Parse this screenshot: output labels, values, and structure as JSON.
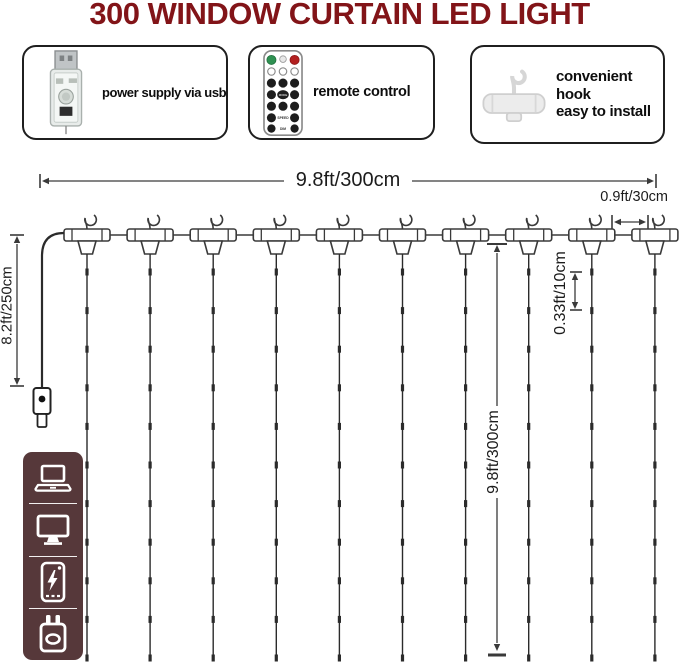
{
  "title": "300 WINDOW CURTAIN LED LIGHT",
  "features": {
    "power": {
      "label": "power supply via usb",
      "icon": "usb-plug-icon"
    },
    "remote": {
      "label": "remote control",
      "icon": "remote-control-icon"
    },
    "hook": {
      "label_line1": "convenient hook",
      "label_line2": "easy to install",
      "icon": "hanger-hook-icon"
    }
  },
  "remote_buttons": {
    "mode": "MODE",
    "speed": "SPEED",
    "dim": "DIM"
  },
  "dimensions": {
    "curtain_width": "9.8ft/300cm",
    "hook_spacing": "0.9ft/30cm",
    "lead_cable": "8.2ft/250cm",
    "curtain_drop": "9.8ft/300cm",
    "led_spacing": "0.33ft/10cm"
  },
  "diagram": {
    "hook_count": 10,
    "led_marks_per_string": 11
  },
  "sidebar": {
    "icons": [
      "laptop-icon",
      "monitor-icon",
      "power-bank-icon",
      "wall-plug-icon"
    ]
  },
  "colors": {
    "title": "#821418",
    "sidebar_bg": "#56383a",
    "diagram_line": "#3a3a3a",
    "remote_green": "#2f9152",
    "remote_red": "#b32020"
  }
}
